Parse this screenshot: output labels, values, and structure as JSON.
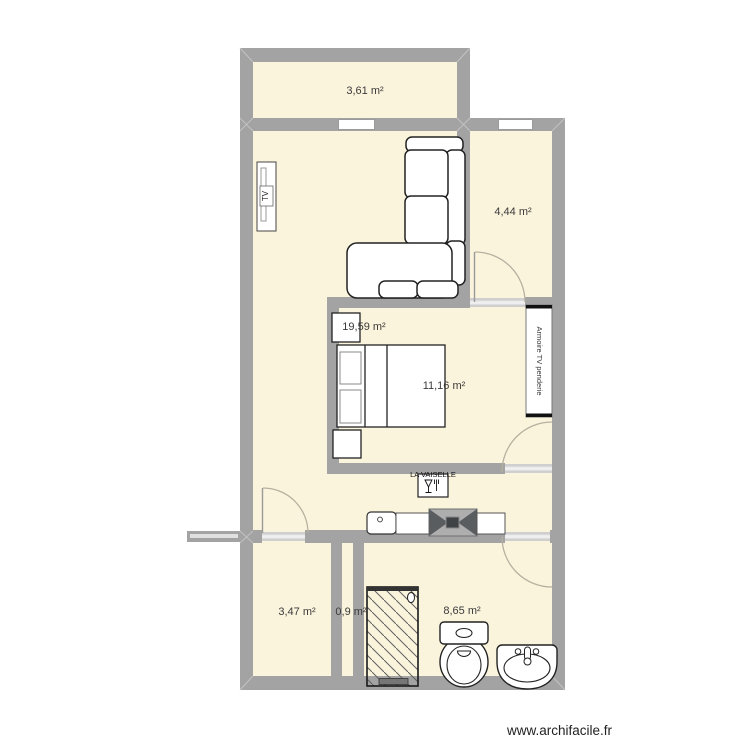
{
  "watermark": "www.archifacile.fr",
  "rooms": [
    {
      "id": "top-room",
      "area_label": "3,61 m²"
    },
    {
      "id": "upper-right",
      "area_label": "4,44 m²"
    },
    {
      "id": "living",
      "area_label": "19,59 m²"
    },
    {
      "id": "bedroom",
      "area_label": "11,16 m²"
    },
    {
      "id": "bottom-left",
      "area_label": "3,47 m²"
    },
    {
      "id": "shaft",
      "area_label": "0,9 m²"
    },
    {
      "id": "bathroom",
      "area_label": "8,65 m²"
    }
  ],
  "furniture": {
    "tv_label": "TV",
    "dishwasher_label": "LA VAISELLE",
    "wardrobe_label": "Armoire TV penderie"
  },
  "colors": {
    "floor_fill": "#fbf4dd",
    "wall": "#a3a3a3",
    "door_arc": "#b8b09f",
    "appliance_dark": "#595d60"
  }
}
